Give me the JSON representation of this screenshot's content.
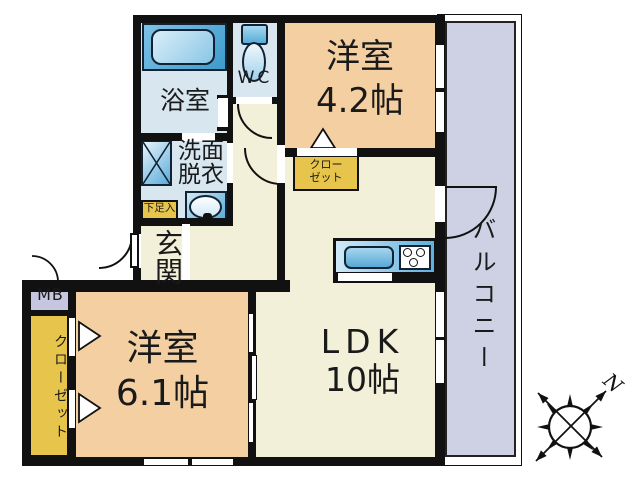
{
  "rooms": {
    "bathroom": {
      "label": "浴室"
    },
    "toilet": {
      "label": "WC"
    },
    "washroom": {
      "line1": "洗面",
      "line2": "脱衣"
    },
    "entrance": {
      "label": "玄関"
    },
    "shoe_cabinet": {
      "label": "下足入"
    },
    "bedroom_4_2": {
      "name": "洋室",
      "size": "4.2帖"
    },
    "closet_upper": {
      "line1": "クロー",
      "line2": "ゼット"
    },
    "meter_box": {
      "label": "MB"
    },
    "closet_left": {
      "label": "クローゼット"
    },
    "bedroom_6_1": {
      "name": "洋室",
      "size": "6.1帖"
    },
    "ldk": {
      "name": "LDK",
      "size": "10帖"
    },
    "balcony": {
      "label": "バルコニー"
    }
  },
  "compass": {
    "north_label": "N"
  },
  "icons": [
    "bathtub-icon",
    "toilet-icon",
    "washing-machine-icon",
    "wash-basin-icon",
    "kitchen-sink-icon",
    "stove-icon",
    "door-swing-arc",
    "closet-door-triangle",
    "compass-rose-icon"
  ],
  "colors": {
    "wall": "#111111",
    "floor_cream": "#f2f0d8",
    "room_peach": "#f4cfa2",
    "wet_room_blue": "#d8e6f0",
    "fixture_blue": "#5aabda",
    "closet_yellow": "#e7c44c",
    "meter_lavender": "#c6c6e0",
    "balcony_lavender": "#cdd1e3"
  }
}
